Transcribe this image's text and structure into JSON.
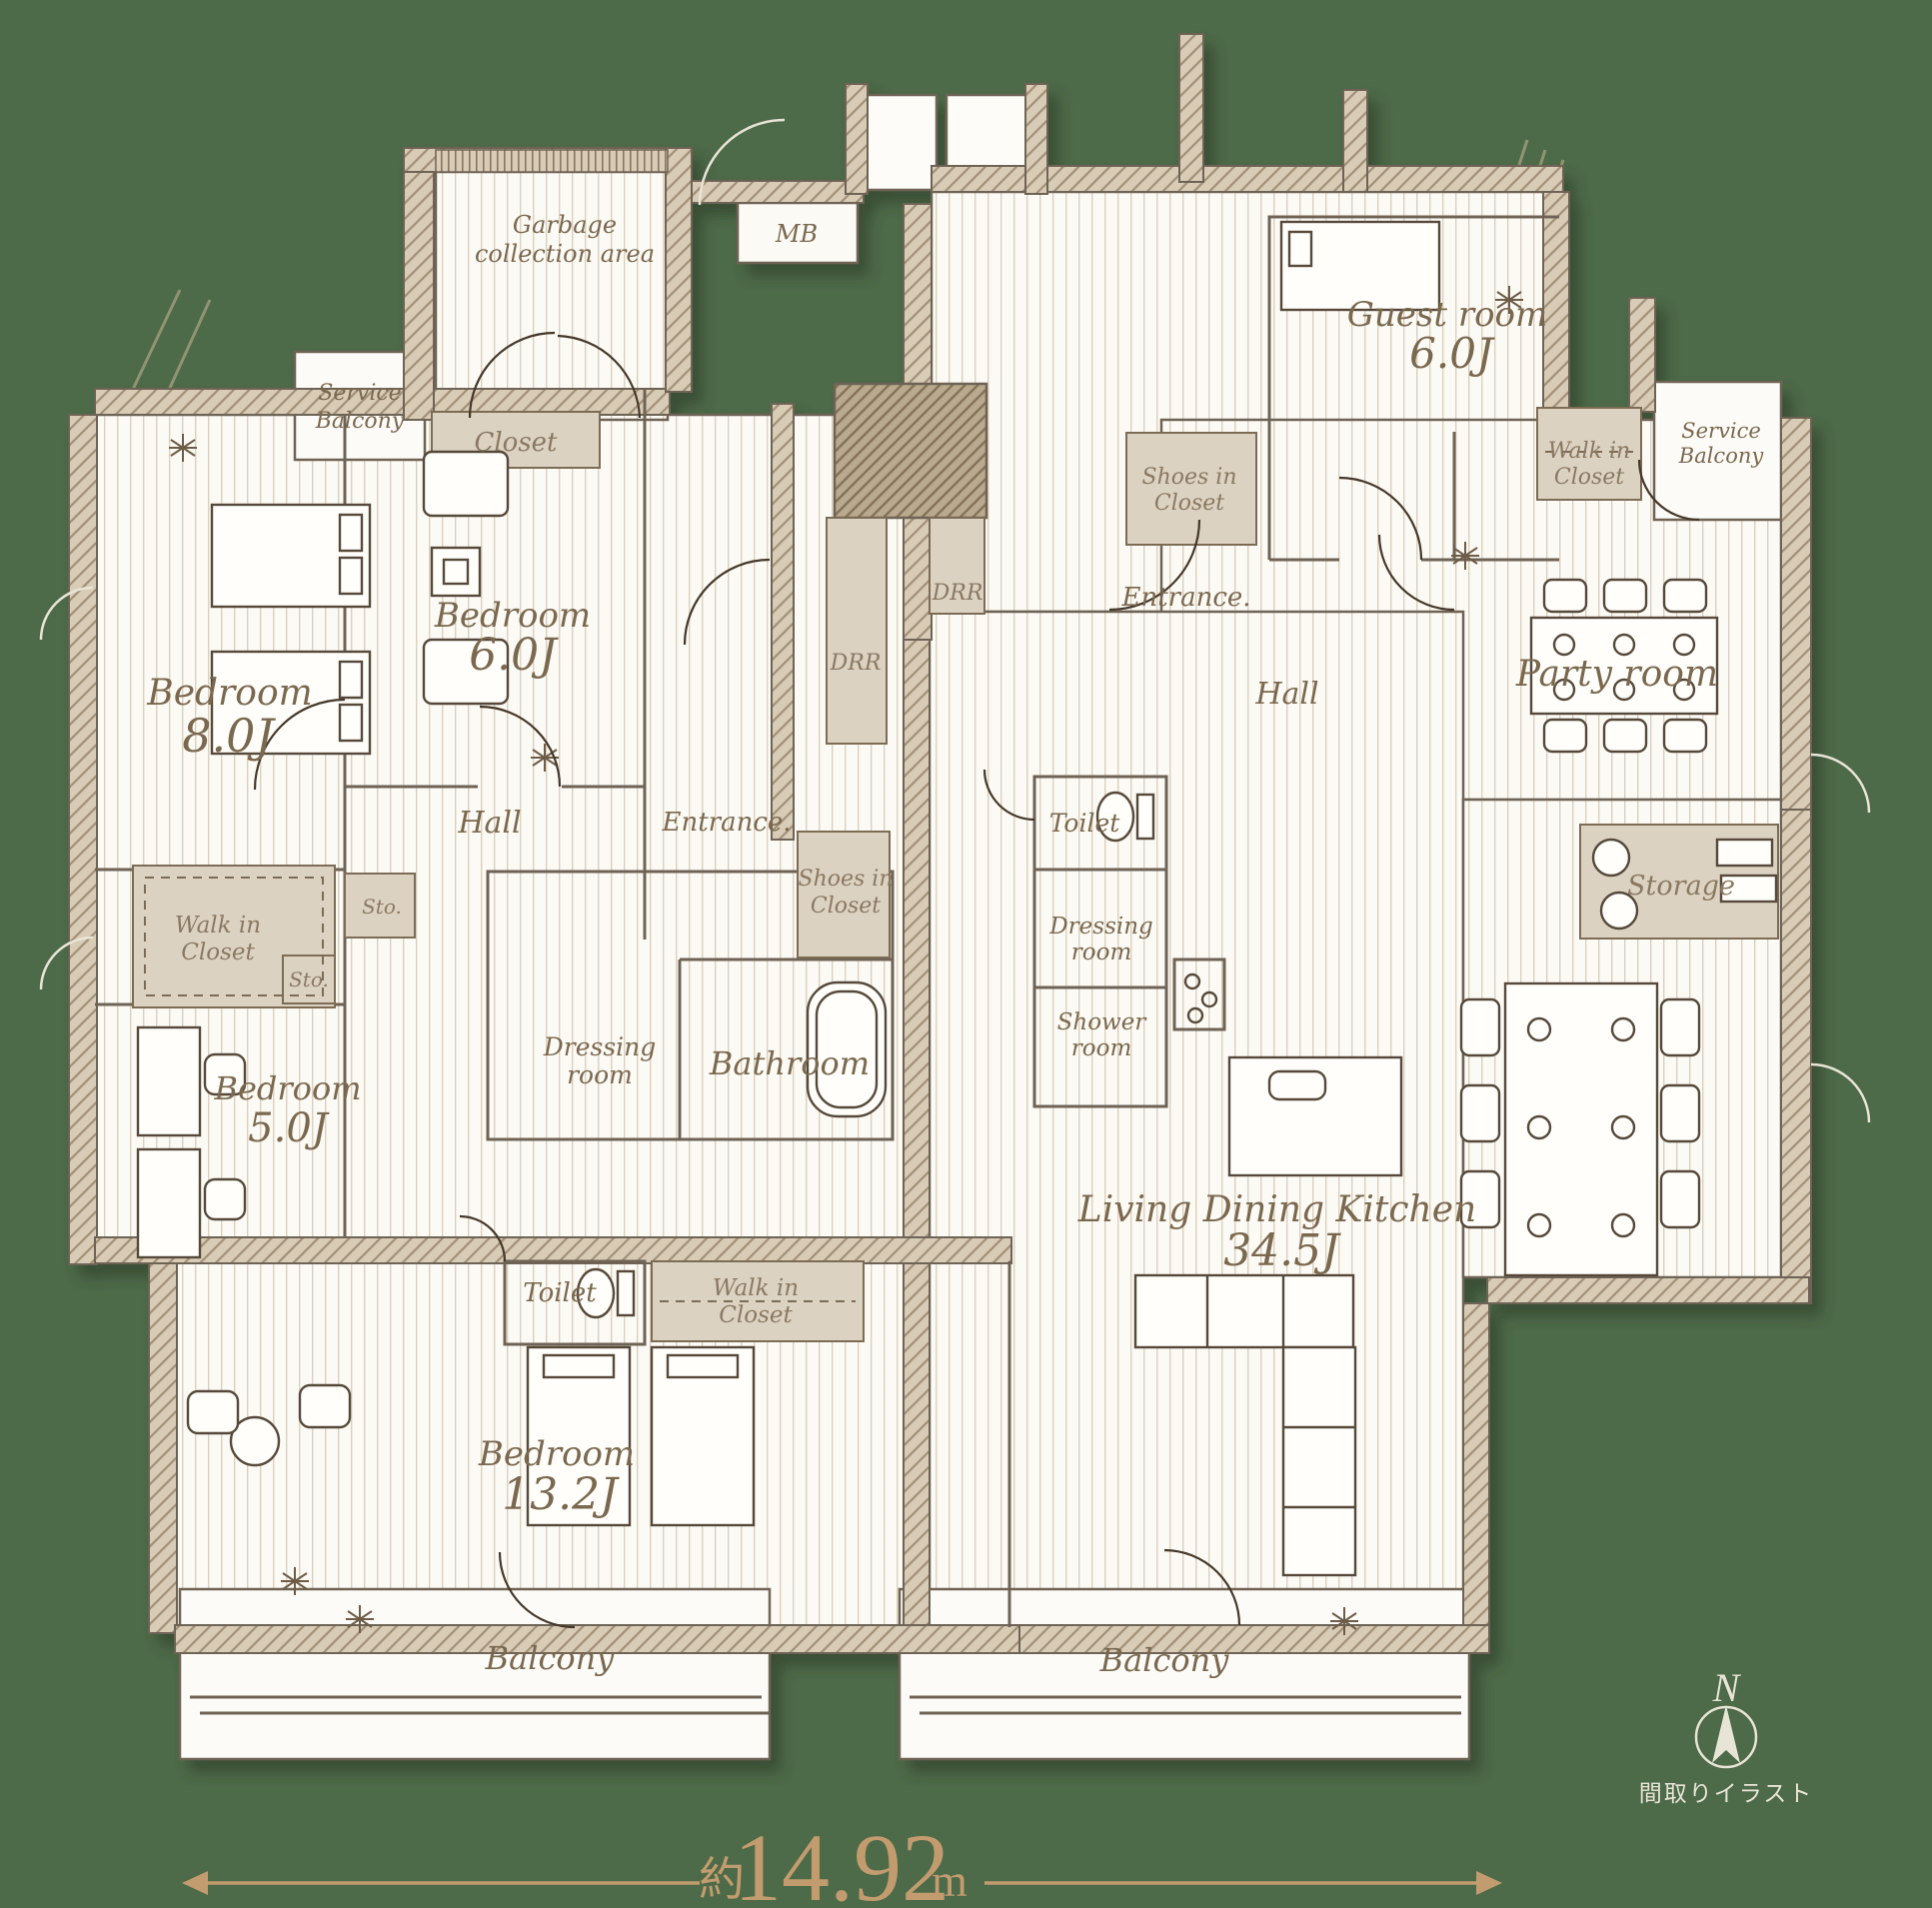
{
  "caption": "間取りイラスト",
  "compass": {
    "north_label": "N"
  },
  "dimension": {
    "prefix": "約",
    "value": "14.92",
    "unit": "m"
  },
  "colors": {
    "background": "#4d6a49",
    "paper": "#fcfaf5",
    "wall_ink": "#6e6355",
    "label_brown": "#7a684f",
    "closet_beige": "#dcd2c1",
    "dimension_gold": "#c29c6e",
    "compass_cream": "#e9e5d6"
  },
  "rooms": {
    "garbage": {
      "line1": "Garbage",
      "line2": "collection area"
    },
    "mb": {
      "label": "MB"
    },
    "service_balcony_left": {
      "line1": "Service",
      "line2": "Balcony"
    },
    "closet_left": {
      "label": "Closet"
    },
    "bedroom8": {
      "name": "Bedroom",
      "size": "8.0J"
    },
    "bedroom6": {
      "name": "Bedroom",
      "size": "6.0J"
    },
    "hall_left": {
      "label": "Hall"
    },
    "entrance_left": {
      "label": "Entrance."
    },
    "shoes_left": {
      "line1": "Shoes in",
      "line2": "Closet"
    },
    "drr_1": {
      "label": "DRR"
    },
    "drr_2": {
      "label": "DRR"
    },
    "wic_left": {
      "line1": "Walk in",
      "line2": "Closet"
    },
    "sto_1": {
      "label": "Sto."
    },
    "sto_2": {
      "label": "Sto."
    },
    "bedroom5": {
      "name": "Bedroom",
      "size": "5.0J"
    },
    "dressing_left": {
      "line1": "Dressing",
      "line2": "room"
    },
    "bathroom": {
      "label": "Bathroom"
    },
    "toilet_left": {
      "label": "Toilet"
    },
    "wic_bottom": {
      "line1": "Walk in",
      "line2": "Closet"
    },
    "bedroom13": {
      "name": "Bedroom",
      "size": "13.2J"
    },
    "balcony_left": {
      "label": "Balcony"
    },
    "guest_room": {
      "name": "Guest room",
      "size": "6.0J"
    },
    "wic_right": {
      "line1": "Walk in",
      "line2": "Closet"
    },
    "service_balcony_right": {
      "line1": "Service",
      "line2": "Balcony"
    },
    "shoes_right": {
      "line1": "Shoes in",
      "line2": "Closet"
    },
    "entrance_right": {
      "label": "Entrance."
    },
    "hall_right": {
      "label": "Hall"
    },
    "party_room": {
      "label": "Party room"
    },
    "toilet_right": {
      "label": "Toilet"
    },
    "dressing_right": {
      "line1": "Dressing",
      "line2": "room"
    },
    "shower_room": {
      "line1": "Shower",
      "line2": "room"
    },
    "storage": {
      "label": "Storage"
    },
    "ldk": {
      "name": "Living Dining Kitchen",
      "size": "34.5J"
    },
    "balcony_right": {
      "label": "Balcony"
    }
  }
}
